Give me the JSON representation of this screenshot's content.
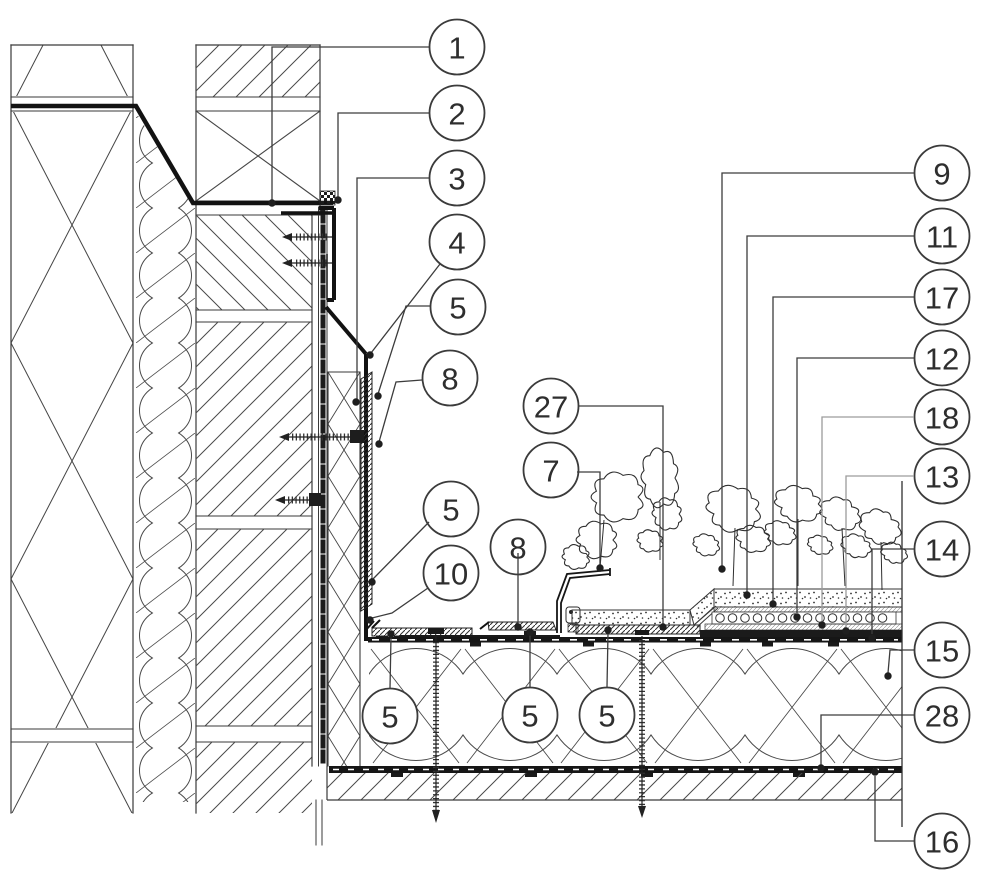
{
  "drawing": {
    "kind": "construction-detail",
    "background": "#ffffff",
    "colors": {
      "line": "#3a3a3a",
      "hatch": "#474747",
      "heavy": "#121212",
      "leader": "#3c3c3c",
      "leader_gray": "#9c9c9c",
      "callout_border": "#3b3b3b",
      "callout_fill": "#ffffff",
      "callout_text": "#2e2e2e",
      "dot": "#1f1f1f"
    }
  },
  "callouts": [
    {
      "id": "callout-1",
      "label": "1",
      "x": 457,
      "y": 47,
      "leader": [
        [
          429,
          47
        ],
        [
          272,
          47
        ],
        [
          272,
          200
        ]
      ],
      "dot": [
        272,
        203
      ]
    },
    {
      "id": "callout-2",
      "label": "2",
      "x": 457,
      "y": 113,
      "leader": [
        [
          429,
          113
        ],
        [
          338,
          113
        ],
        [
          338,
          197
        ]
      ],
      "dot": [
        338,
        200
      ]
    },
    {
      "id": "callout-3",
      "label": "3",
      "x": 457,
      "y": 178,
      "leader": [
        [
          429,
          178
        ],
        [
          357,
          178
        ],
        [
          357,
          399
        ]
      ],
      "dot": [
        356,
        402
      ]
    },
    {
      "id": "callout-4",
      "label": "4",
      "x": 457,
      "y": 242,
      "leader": [
        [
          440,
          264
        ],
        [
          371,
          353
        ]
      ],
      "dot": [
        370,
        355
      ]
    },
    {
      "id": "callout-5a",
      "label": "5",
      "x": 458,
      "y": 307,
      "leader": [
        [
          430,
          306
        ],
        [
          406,
          306
        ],
        [
          378,
          394
        ]
      ],
      "dot": [
        378,
        396
      ]
    },
    {
      "id": "callout-8a",
      "label": "8",
      "x": 450,
      "y": 378,
      "leader": [
        [
          422,
          380
        ],
        [
          396,
          382
        ],
        [
          379,
          442
        ]
      ],
      "dot": [
        379,
        444
      ]
    },
    {
      "id": "callout-5b",
      "label": "5",
      "x": 451,
      "y": 509,
      "leader": [
        [
          429,
          522
        ],
        [
          373,
          579
        ]
      ],
      "dot": [
        372,
        582
      ]
    },
    {
      "id": "callout-10",
      "label": "10",
      "x": 451,
      "y": 573,
      "leader": [
        [
          428,
          588
        ],
        [
          392,
          613
        ],
        [
          372,
          618
        ]
      ],
      "dot": [
        370,
        620
      ]
    },
    {
      "id": "callout-27",
      "label": "27",
      "x": 551,
      "y": 406,
      "leader": [
        [
          579,
          406
        ],
        [
          663,
          406
        ],
        [
          663,
          624
        ]
      ],
      "dot": [
        663,
        627
      ]
    },
    {
      "id": "callout-7",
      "label": "7",
      "x": 551,
      "y": 470,
      "leader": [
        [
          577,
          472
        ],
        [
          600,
          472
        ],
        [
          600,
          565
        ]
      ],
      "dot": [
        600,
        568
      ]
    },
    {
      "id": "callout-8b",
      "label": "8",
      "x": 518,
      "y": 547,
      "leader": [
        [
          518,
          553
        ],
        [
          518,
          624
        ]
      ],
      "dot": [
        518,
        627
      ]
    },
    {
      "id": "callout-5c",
      "label": "5",
      "x": 390,
      "y": 716,
      "leader": [
        [
          390,
          688
        ],
        [
          391,
          637
        ]
      ],
      "dot": [
        391,
        634
      ]
    },
    {
      "id": "callout-5d",
      "label": "5",
      "x": 530,
      "y": 715,
      "leader": [
        [
          530,
          687
        ],
        [
          530,
          635
        ]
      ],
      "dot": [
        530,
        632
      ]
    },
    {
      "id": "callout-5e",
      "label": "5",
      "x": 607,
      "y": 715,
      "leader": [
        [
          607,
          687
        ],
        [
          608,
          633
        ]
      ],
      "dot": [
        608,
        630
      ]
    },
    {
      "id": "callout-9",
      "label": "9",
      "x": 942,
      "y": 173,
      "leader": [
        [
          914,
          173
        ],
        [
          722,
          173
        ],
        [
          722,
          566
        ]
      ],
      "dot": [
        722,
        569
      ]
    },
    {
      "id": "callout-11",
      "label": "11",
      "x": 942,
      "y": 236,
      "leader": [
        [
          914,
          236
        ],
        [
          747,
          236
        ],
        [
          747,
          592
        ]
      ],
      "dot": [
        747,
        595
      ]
    },
    {
      "id": "callout-17",
      "label": "17",
      "x": 942,
      "y": 297,
      "leader": [
        [
          914,
          297
        ],
        [
          773,
          297
        ],
        [
          773,
          601
        ]
      ],
      "dot": [
        773,
        604
      ]
    },
    {
      "id": "callout-12",
      "label": "12",
      "x": 942,
      "y": 358,
      "leader": [
        [
          914,
          358
        ],
        [
          797,
          358
        ],
        [
          797,
          613
        ]
      ],
      "dot": [
        797,
        617
      ]
    },
    {
      "id": "callout-18",
      "label": "18",
      "x": 942,
      "y": 417,
      "leader": [
        [
          914,
          417
        ],
        [
          822,
          417
        ],
        [
          822,
          622
        ]
      ],
      "dot": [
        822,
        625
      ],
      "gray": true
    },
    {
      "id": "callout-13",
      "label": "13",
      "x": 942,
      "y": 476,
      "leader": [
        [
          914,
          476
        ],
        [
          846,
          476
        ],
        [
          846,
          628
        ]
      ],
      "dot": [
        846,
        631
      ],
      "gray": true
    },
    {
      "id": "callout-14",
      "label": "14",
      "x": 942,
      "y": 549,
      "leader": [
        [
          914,
          549
        ],
        [
          872,
          549
        ],
        [
          872,
          634
        ]
      ],
      "dot": [
        872,
        638
      ]
    },
    {
      "id": "callout-15",
      "label": "15",
      "x": 942,
      "y": 650,
      "leader": [
        [
          914,
          650
        ],
        [
          890,
          650
        ],
        [
          888,
          673
        ]
      ],
      "dot": [
        888,
        676
      ]
    },
    {
      "id": "callout-28",
      "label": "28",
      "x": 942,
      "y": 715,
      "leader": [
        [
          914,
          715
        ],
        [
          821,
          715
        ],
        [
          821,
          765
        ]
      ],
      "dot": [
        821,
        768
      ]
    },
    {
      "id": "callout-16",
      "label": "16",
      "x": 942,
      "y": 841,
      "leader": [
        [
          914,
          841
        ],
        [
          875,
          841
        ],
        [
          875,
          776
        ]
      ],
      "dot": [
        875,
        772
      ]
    }
  ]
}
